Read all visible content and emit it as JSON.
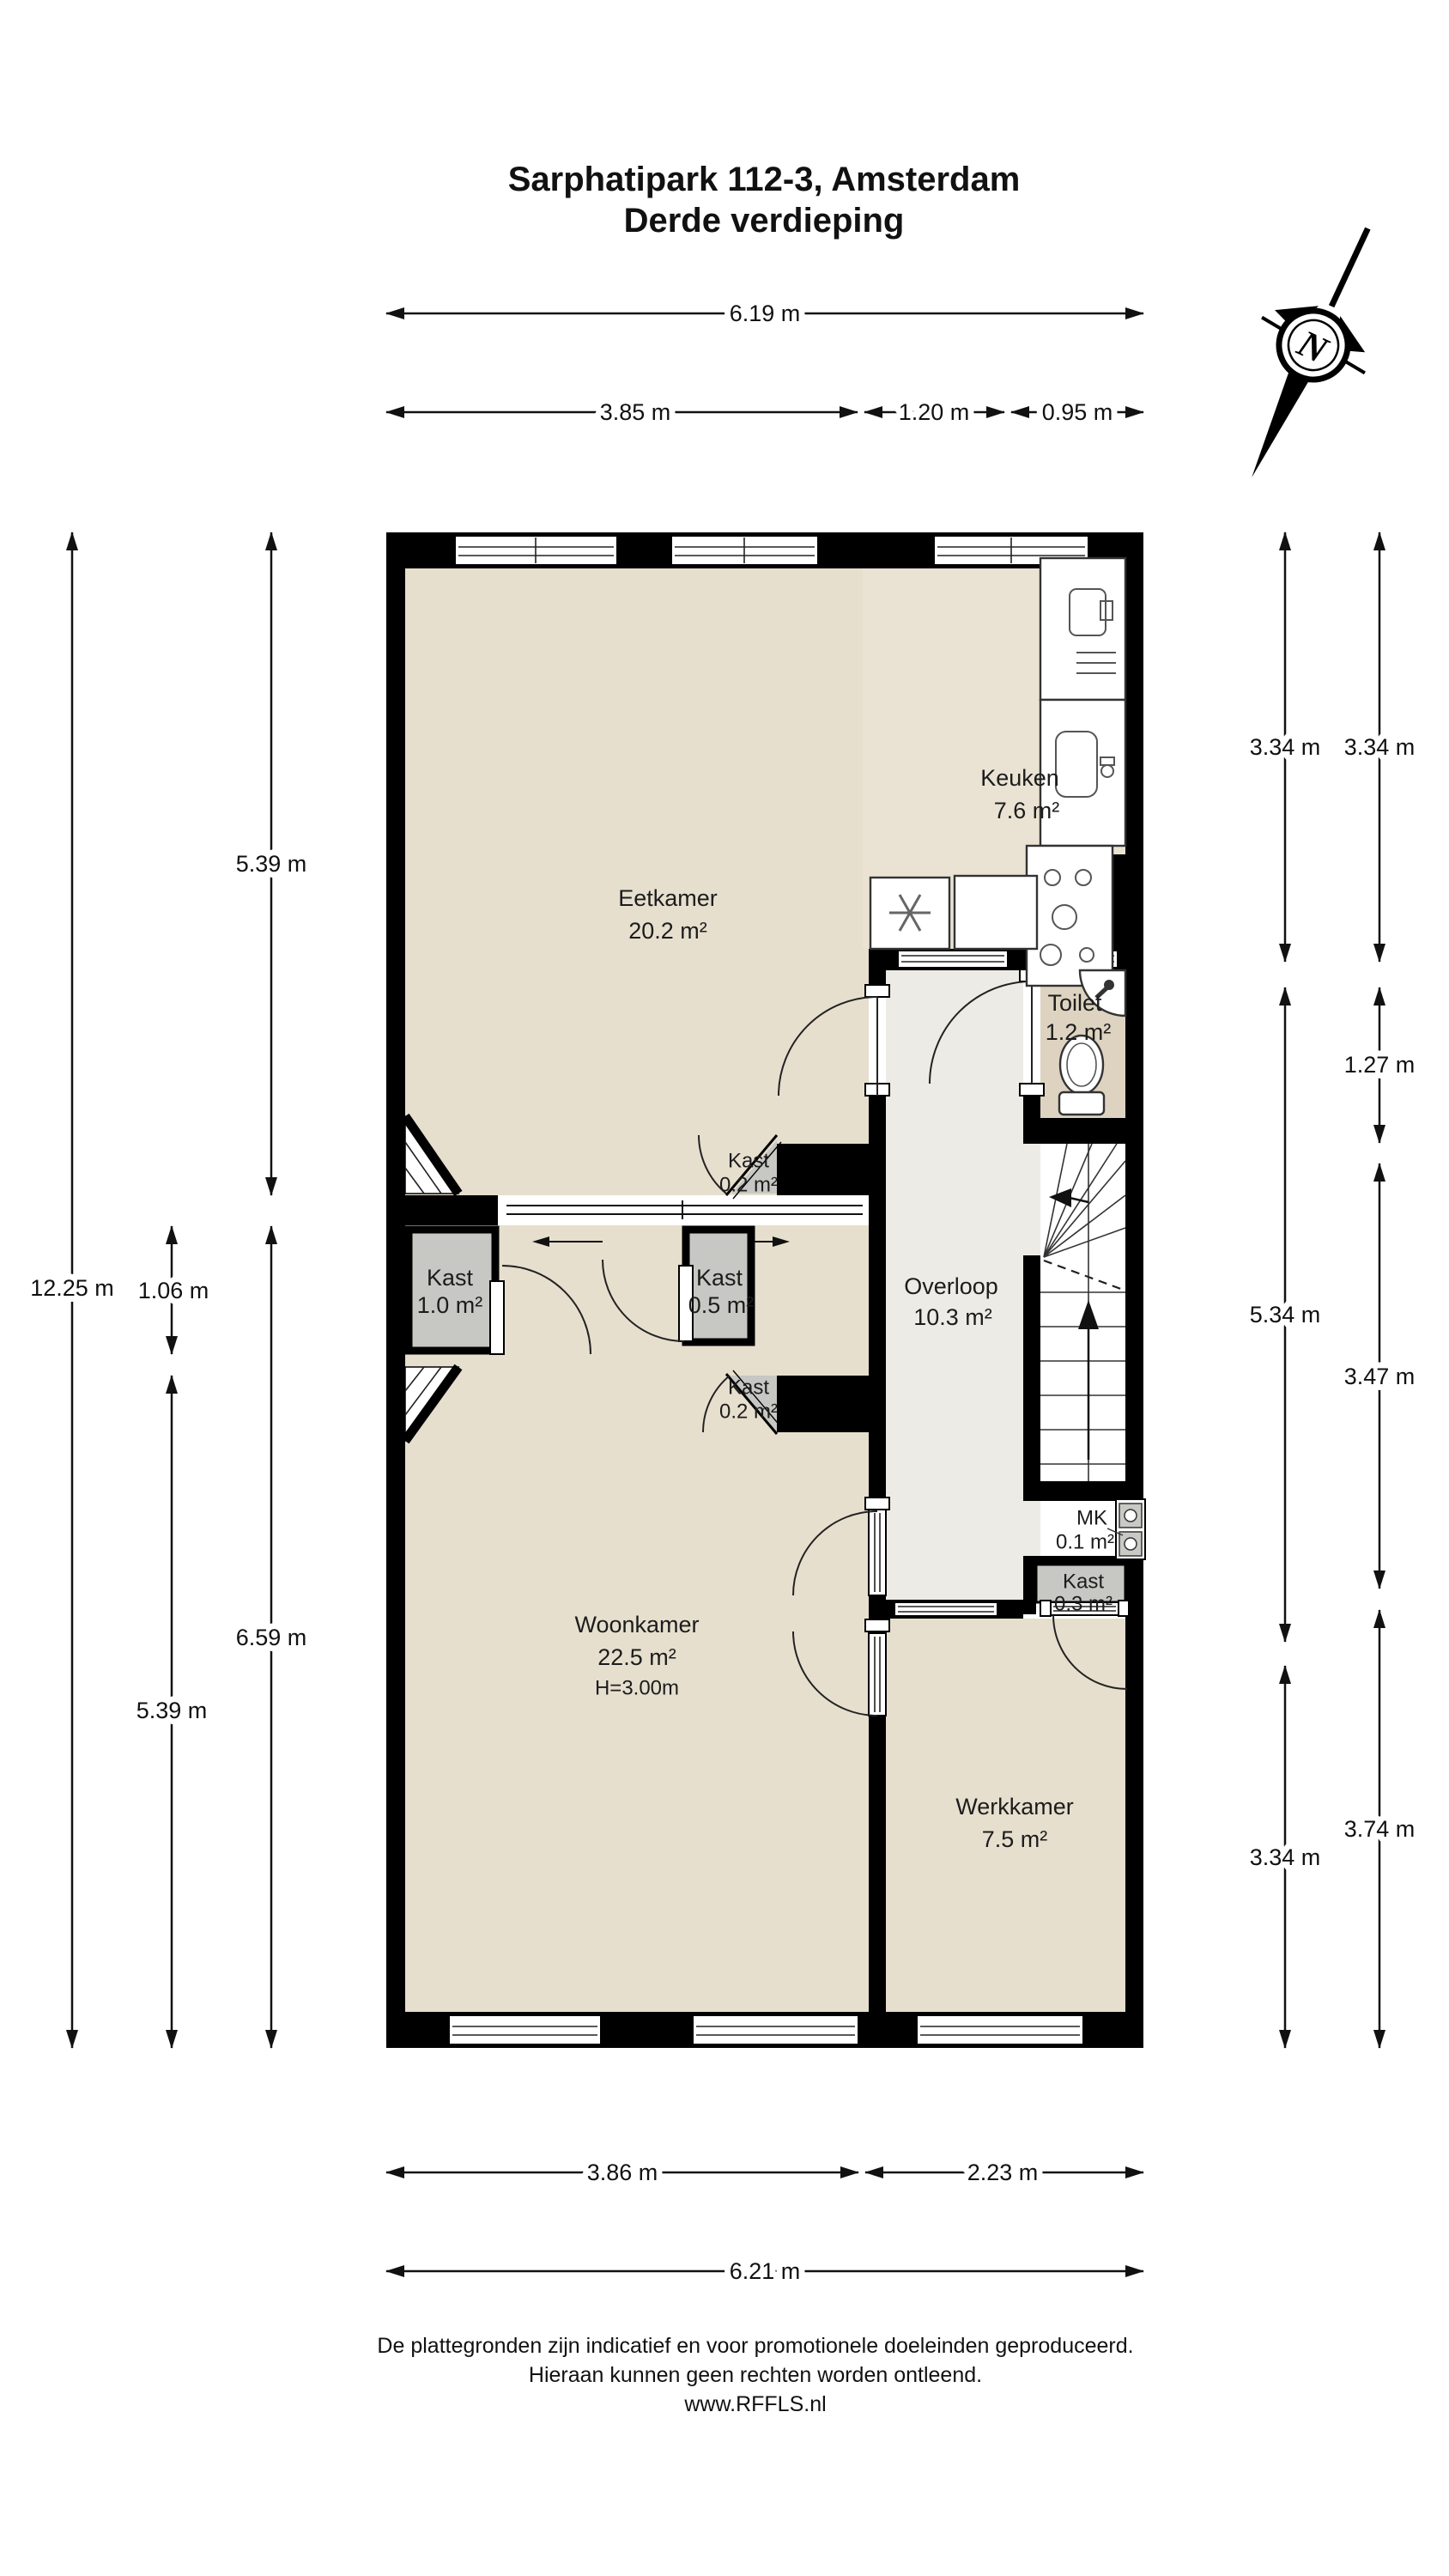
{
  "title": {
    "address": "Sarphatipark 112-3, Amsterdam",
    "floor": "Derde verdieping"
  },
  "compass": {
    "north": "N"
  },
  "rooms": {
    "eetkamer": {
      "name": "Eetkamer",
      "area": "20.2 m²"
    },
    "keuken": {
      "name": "Keuken",
      "area": "7.6 m²"
    },
    "toilet": {
      "name": "Toilet",
      "area": "1.2 m²"
    },
    "overloop": {
      "name": "Overloop",
      "area": "10.3 m²"
    },
    "woonkamer": {
      "name": "Woonkamer",
      "area": "22.5 m²",
      "ceiling": "H=3.00m"
    },
    "werkkamer": {
      "name": "Werkkamer",
      "area": "7.5 m²"
    },
    "kast_boven": {
      "name": "Kast",
      "area": "0.2 m²"
    },
    "kast_links": {
      "name": "Kast",
      "area": "1.0 m²"
    },
    "kast_midden": {
      "name": "Kast",
      "area": "0.5 m²"
    },
    "kast_onder": {
      "name": "Kast",
      "area": "0.2 m²"
    },
    "meterkast": {
      "name": "MK",
      "area": "0.1 m²"
    },
    "kast_werk": {
      "name": "Kast",
      "area": "0.3 m²"
    }
  },
  "dimensions": {
    "top_total": "6.19 m",
    "top_left": "3.85 m",
    "top_mid": "1.20 m",
    "top_right": "0.95 m",
    "left_total": "12.25 m",
    "left_kast": "1.06 m",
    "left_upper": "5.39 m",
    "left_lower": "5.39 m",
    "left_woonkamer": "6.59 m",
    "right_inner_top": "3.34 m",
    "right_inner_mid": "5.34 m",
    "right_inner_bottom": "3.34 m",
    "right_outer_top": "3.34 m",
    "right_outer_toilet": "1.27 m",
    "right_outer_trap": "3.47 m",
    "right_outer_bottom": "3.74 m",
    "bottom_left": "3.86 m",
    "bottom_right": "2.23 m",
    "bottom_total": "6.21 m"
  },
  "footer": {
    "line1": "De plattegronden zijn indicatief en voor promotionele doeleinden geproduceerd.",
    "line2": "Hieraan kunnen geen rechten worden ontleend.",
    "line3": "www.RFFLS.nl"
  },
  "colors": {
    "wall": "#000000",
    "room_beige": "#e6dfce",
    "keuken": "#eae3d4",
    "toilet": "#ddd3c0",
    "hal": "#edebe5",
    "kast": "#c7c7c3"
  }
}
